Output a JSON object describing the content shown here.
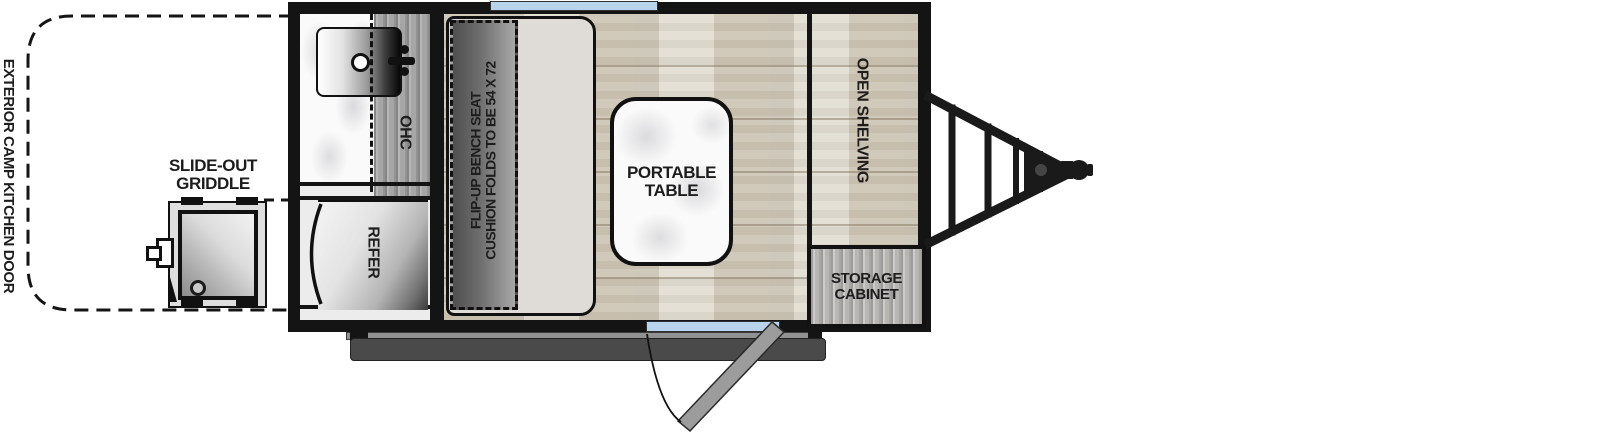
{
  "title": "Travel trailer floorplan with exterior camp kitchen",
  "labels": {
    "exterior_door": "EXTERIOR CAMP KITCHEN DOOR",
    "griddle_l1": "SLIDE-OUT",
    "griddle_l2": "GRIDDLE",
    "ohc": "OHC",
    "refer": "REFER",
    "bench_l1": "FLIP-UP BENCH SEAT",
    "bench_l2": "CUSHION FOLDS TO BE 54 X 72",
    "table_l1": "PORTABLE",
    "table_l2": "TABLE",
    "shelving": "OPEN SHELVING",
    "storage_l1": "STORAGE",
    "storage_l2": "CABINET"
  },
  "colors": {
    "wall": "#141414",
    "window_blue": "#b7d4ec",
    "floor_wood": "#d7d1c3",
    "galley_gray": "#ececec",
    "cushion": "#dfdcd7",
    "ohc_wood": "#a6a6a6",
    "cabinet_wood": "#b8b6b3",
    "step_gray": "#4a4a4a",
    "door_panel_gray": "#9c9c9c",
    "text": "#1d1d1d"
  }
}
